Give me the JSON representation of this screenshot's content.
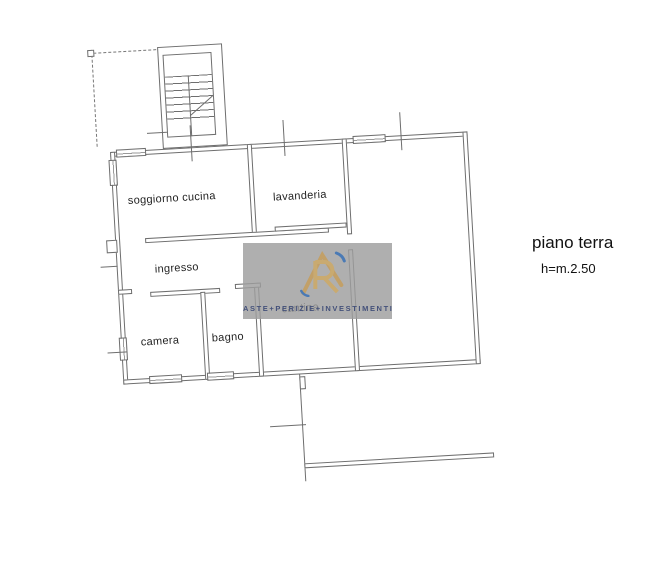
{
  "annotation": {
    "floor_label": "piano terra",
    "height_label": "h=m.2.50"
  },
  "rooms": [
    {
      "label": "soggiorno cucina"
    },
    {
      "label": "lavanderia"
    },
    {
      "label": "ingresso"
    },
    {
      "label": "cantina"
    },
    {
      "label": "camera"
    },
    {
      "label": "bagno"
    }
  ],
  "watermark": {
    "tagline": "ASTE+PERIZIE+INVESTIMENTI",
    "logo": "ri-monogram-logo",
    "colors": {
      "box": "#9e9e9e",
      "gold": "#c2a068",
      "blue": "#4a7ab5",
      "text": "#44517a"
    }
  },
  "drawing": {
    "line_color": "#6e6e6e"
  }
}
